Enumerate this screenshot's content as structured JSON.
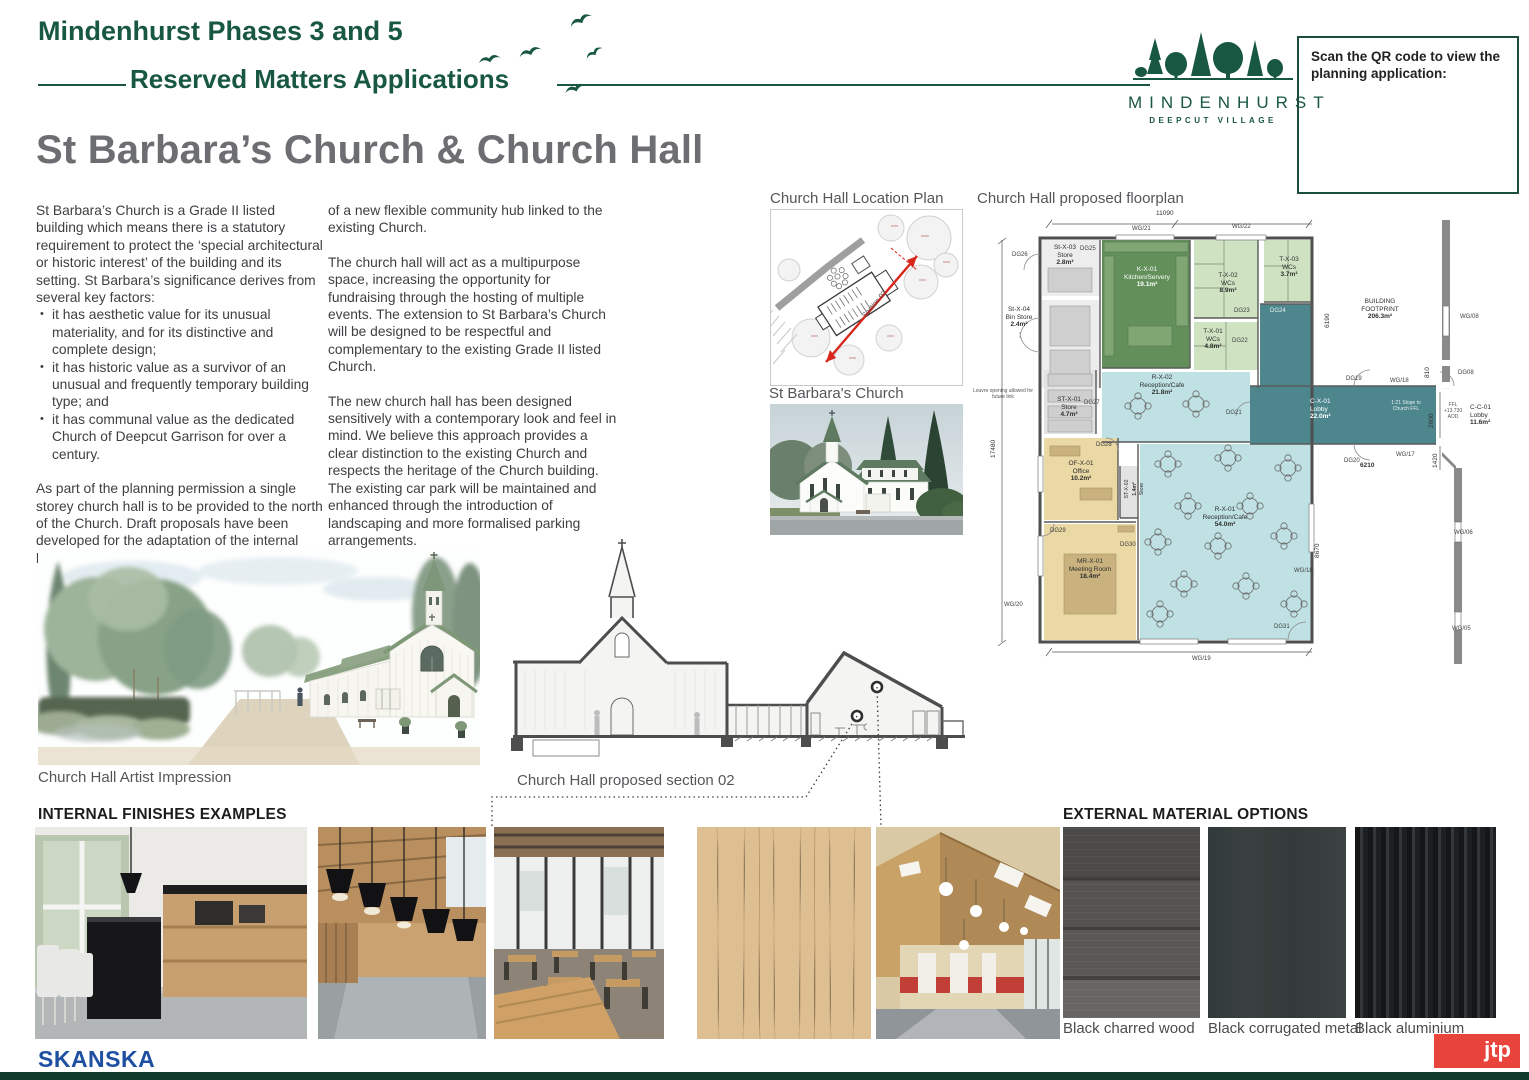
{
  "header": {
    "title_line1": "Mindenhurst Phases 3 and 5",
    "title_line2": "Reserved Matters Applications"
  },
  "logo": {
    "name": "MINDENHURST",
    "tagline": "DEEPCUT VILLAGE"
  },
  "qr_box": {
    "text": "Scan the QR code to view the planning application:"
  },
  "page_title": "St Barbara’s Church & Church Hall",
  "intro": {
    "col1_p1": "St Barbara’s Church is a Grade II listed building which means there is a statutory requirement to protect the ‘special architectural or historic interest’ of the building and its setting. St Barbara’s significance derives from several key factors:",
    "bullets": [
      "it has aesthetic value for its unusual materiality, and for its distinctive and complete design;",
      "it has historic value as a survivor of an unusual and frequently temporary building type; and",
      "it has communal value as the dedicated Church of Deepcut Garrison for over a century."
    ],
    "col1_p2": "As part of the planning permission a single storey church hall is to be provided to the north of the Church. Draft proposals have been developed for the adaptation of the internal layout of St Barbara’s Church and the creation",
    "col2_p1": "of a new flexible community hub linked to the existing Church.",
    "col2_p2": "The church hall will act as a multipurpose space, increasing the opportunity for fundraising through the hosting of multiple events. The extension to St Barbara’s Church will be designed to be respectful and complementary to the existing Grade II listed Church.",
    "col2_p3": "The new church hall has been designed sensitively with a contemporary look and feel in mind. We believe this approach provides a clear distinction to the existing Church and respects the heritage of the Church building. The existing car park will be maintained and enhanced through the introduction of landscaping and more formalised parking arrangements."
  },
  "figures": {
    "location_plan_caption": "Church Hall Location Plan",
    "church_photo_caption": "St Barbara's Church",
    "floorplan_caption": "Church Hall proposed floorplan",
    "artist_caption": "Church Hall Artist Impression",
    "section_caption": "Church Hall proposed section 02",
    "section_arrow_label": "Section 02"
  },
  "floorplan": {
    "rooms": {
      "st_x_03": {
        "code": "St-X-03",
        "name": "Store",
        "area": "2.8m²"
      },
      "st_x_04": {
        "code": "St-X-04",
        "name": "Bin Store",
        "area": "2.4m²"
      },
      "k_x_01": {
        "code": "K-X-01",
        "name": "Kitchen/Servery",
        "area": "19.1m²"
      },
      "t_x_02": {
        "code": "T-X-02",
        "name": "WCs",
        "area": "8.9m²"
      },
      "t_x_03": {
        "code": "T-X-03",
        "name": "WCs",
        "area": "3.7m²"
      },
      "t_x_01": {
        "code": "T-X-01",
        "name": "WCs",
        "area": "4.8m²"
      },
      "r_x_02": {
        "code": "R-X-02",
        "name": "Reception/Cafe",
        "area": "21.8m²"
      },
      "st_x_01": {
        "code": "ST-X-01",
        "name": "Store",
        "area": "4.7m²"
      },
      "of_x_01": {
        "code": "OF-X-01",
        "name": "Office",
        "area": "10.2m²"
      },
      "st_x_02": {
        "code": "ST-X-02",
        "name": "Store",
        "area": "1.4m²"
      },
      "mr_x_01": {
        "code": "MR-X-01",
        "name": "Meeting Room",
        "area": "18.4m²"
      },
      "r_x_01": {
        "code": "R-X-01",
        "name": "Reception/Cafe",
        "area": "54.0m²"
      },
      "c_x_01": {
        "code": "C-X-01",
        "name": "Lobby",
        "area": "22.0m²"
      },
      "c_c_01": {
        "code": "C-C-01",
        "name": "Lobby",
        "area": "11.6m²"
      }
    },
    "tags": {
      "dg25": "DG25",
      "dg26": "DG26",
      "dg27": "DG27",
      "dg28": "DG28",
      "dg29": "DG29",
      "dg30": "DG30",
      "dg31": "DG31",
      "dg21": "DG21",
      "dg22": "DG22",
      "dg23": "DG23",
      "dg24": "DG24",
      "dg19": "DG19",
      "dg20": "DG20",
      "dg08": "DG08",
      "wg21": "WG/21",
      "wg22": "WG/22",
      "wg20": "WG/20",
      "wg19": "WG/19",
      "wg18a": "WG/18",
      "wg18b": "WG/18",
      "wg17": "WG/17",
      "wg08": "WG/08",
      "wg06": "WG/06",
      "wg05": "WG/05"
    },
    "dims": {
      "d11090": "11090",
      "d17480": "17480",
      "d6190": "6190",
      "d8670": "8670",
      "d2600": "2600",
      "d810": "810",
      "d1420": "1420",
      "d6210": "6210"
    },
    "notes": {
      "footprint1": "BUILDING",
      "footprint2": "FOOTPRINT",
      "footprint3": "206.3m²",
      "louvre": "Louvre opening allowed for future link",
      "slope": "1:21 Slope to Church FFL",
      "ffl": "FFL +13.730 AOD"
    }
  },
  "internal": {
    "heading": "INTERNAL FINISHES EXAMPLES"
  },
  "external": {
    "heading": "EXTERNAL MATERIAL OPTIONS",
    "materials": [
      "Black charred wood",
      "Black corrugated metal",
      "Black aluminium"
    ]
  },
  "footer": {
    "skanska": "SKANSKA",
    "jtp": "jtp"
  }
}
